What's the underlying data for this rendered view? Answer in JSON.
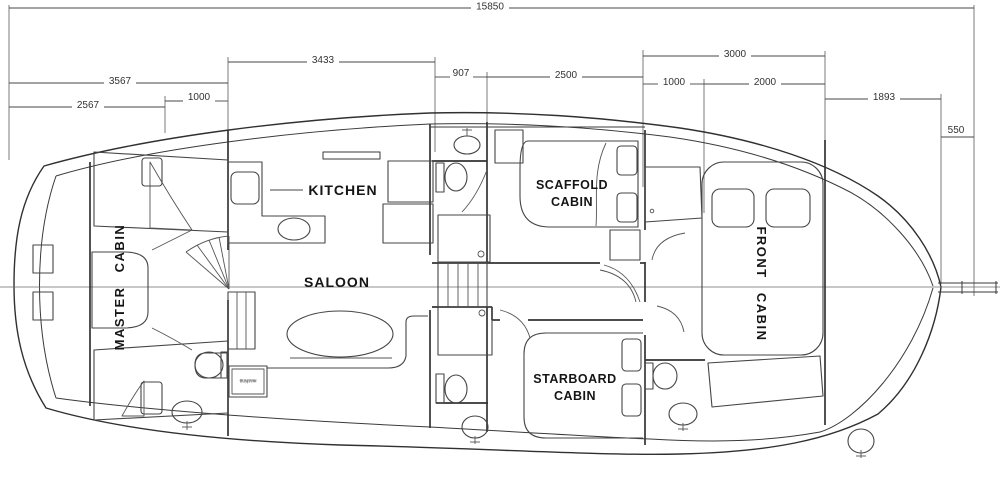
{
  "dims": {
    "overall": "15850",
    "aft": "3567",
    "master": "2567",
    "aft_step": "1000",
    "saloon": "3433",
    "corridor": "907",
    "mid": "2500",
    "front": "3000",
    "front_closet": "1000",
    "front_bed": "2000",
    "bow": "1893",
    "bowsprit": "550"
  },
  "labels": {
    "master_cabin": "MASTER CABIN",
    "kitchen": "KITCHEN",
    "saloon": "SALOON",
    "scaffold_1": "SCAFFOLD",
    "scaffold_2": "CABIN",
    "starboard_1": "STARBOARD",
    "starboard_2": "CABIN",
    "front_cabin": "FRONT CABIN",
    "appliance_1": "washing",
    "appliance_2": "machine"
  },
  "colors": {
    "line": "#303030",
    "background": "#ffffff"
  }
}
